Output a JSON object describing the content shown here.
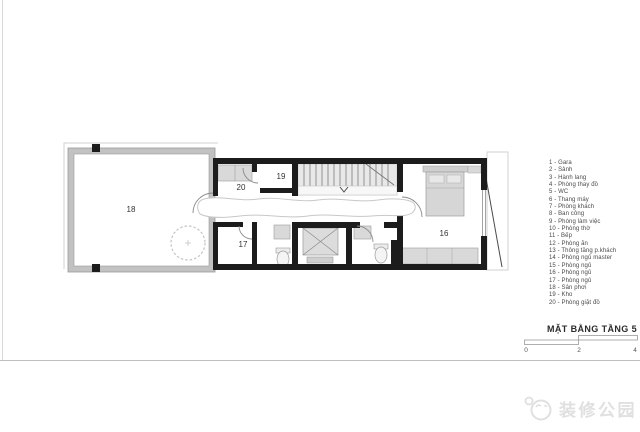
{
  "plan": {
    "room_labels": {
      "r16": "16",
      "r17": "17",
      "r18": "18",
      "r19": "19",
      "r20": "20"
    }
  },
  "legend": {
    "items": [
      "1 - Gara",
      "2 - Sảnh",
      "3 - Hành lang",
      "4 - Phòng thay đồ",
      "5 - WC",
      "6 - Thang máy",
      "7 - Phòng khách",
      "8 - Ban công",
      "9 - Phòng làm việc",
      "10 - Phòng thờ",
      "11 - Bếp",
      "12 - Phòng ăn",
      "13 - Thông tầng p.khách",
      "14 - Phòng ngủ master",
      "15 - Phòng ngủ",
      "16 - Phòng ngủ",
      "17 - Phòng ngủ",
      "18 - Sân phơi",
      "19 - Kho",
      "20 - Phòng giặt đồ"
    ]
  },
  "title_block": {
    "title": "MẶT BẰNG TẦNG 5",
    "scale_ticks": [
      "0",
      "2",
      "4"
    ]
  },
  "watermark": {
    "text": "装修公园"
  },
  "colors": {
    "wall_black": "#1c1c1c",
    "wall_gray": "#c2c2c2",
    "furniture_gray": "#d9d9d9",
    "legend_text": "#4a4a4a",
    "watermark_gray": "#e0e0e0"
  }
}
